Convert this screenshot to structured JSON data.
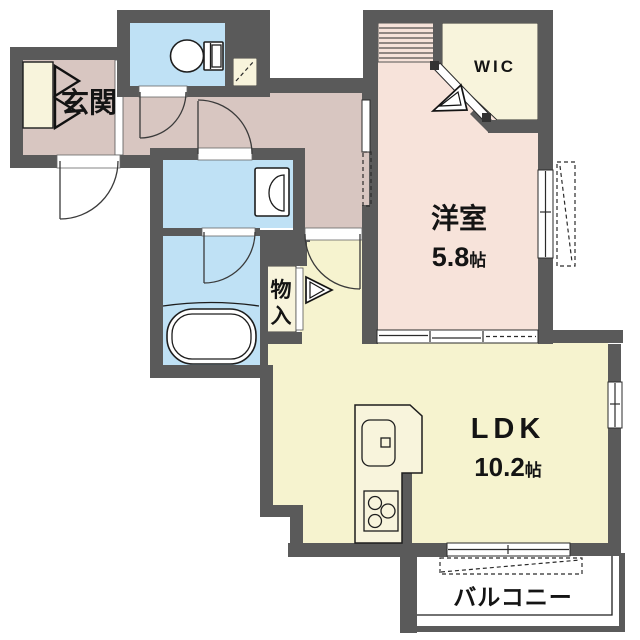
{
  "colors": {
    "wall": "#5a5a5a",
    "hall": "#d8c6c1",
    "bedroom": "#f7e3da",
    "wet": "#bfe1f5",
    "ldk": "#f6f3cf",
    "cream": "#f8f4dc"
  },
  "rooms": {
    "genkan": {
      "label": "玄関"
    },
    "bedroom": {
      "label": "洋室",
      "size_value": "5.8",
      "size_unit": "帖"
    },
    "ldk": {
      "label": "LDK",
      "size_value": "10.2",
      "size_unit": "帖"
    },
    "wic": {
      "label": "WIC"
    },
    "storage": {
      "label": "物入"
    },
    "balcony": {
      "label": "バルコニー"
    }
  },
  "fixtures": [
    "toilet",
    "washbasin",
    "bathtub",
    "kitchen-sink",
    "gas-stove",
    "shoe-cabinet"
  ]
}
